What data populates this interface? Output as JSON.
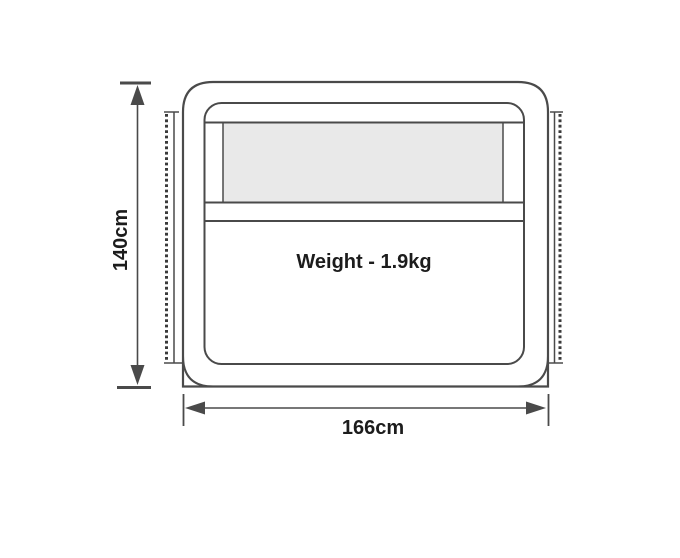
{
  "diagram": {
    "height_label": "140cm",
    "width_label": "166cm",
    "weight_label": "Weight - 1.9kg"
  },
  "colors": {
    "line": "#4a4a4a",
    "dot": "#3a3a3a",
    "window_fill": "#e9e9e9",
    "panel_fill": "#ffffff",
    "background": "#ffffff",
    "text": "#1c1c1c"
  }
}
